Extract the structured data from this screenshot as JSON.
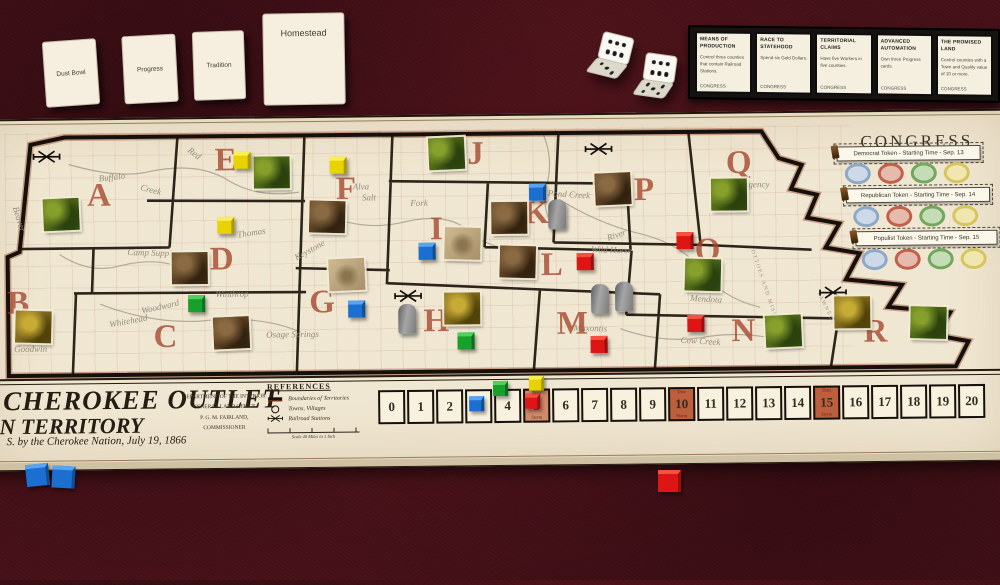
{
  "hand_cards": [
    {
      "label": "Dust Bowl",
      "x": 44,
      "y": 40,
      "w": 52,
      "h": 64,
      "rot": -4,
      "text_pos": "center"
    },
    {
      "label": "Progress",
      "x": 123,
      "y": 35,
      "w": 52,
      "h": 66,
      "rot": -3,
      "text_pos": "center"
    },
    {
      "label": "Tradition",
      "x": 193,
      "y": 31,
      "w": 50,
      "h": 67,
      "rot": -2,
      "text_pos": "center"
    },
    {
      "label": "Homestead",
      "x": 263,
      "y": 13,
      "w": 82,
      "h": 92,
      "rot": -1,
      "text_pos": "top"
    }
  ],
  "dice": [
    {
      "x": 598,
      "y": 34,
      "rot": 14,
      "top": 6,
      "front": 3
    },
    {
      "x": 643,
      "y": 54,
      "rot": 8,
      "top": 6,
      "front": 5
    }
  ],
  "goal_cards": {
    "x": 688,
    "y": 27,
    "w": 312,
    "h": 74,
    "cards": [
      {
        "title": "MEANS OF PRODUCTION",
        "body": "Control three counties that contain Railroad Stations.",
        "footer": "CONGRESS"
      },
      {
        "title": "RACE TO STATEHOOD",
        "body": "Spend six Gold Dollars.",
        "footer": "CONGRESS"
      },
      {
        "title": "TERRITORIAL CLAIMS",
        "body": "Have five Workers in five counties.",
        "footer": "CONGRESS"
      },
      {
        "title": "ADVANCED AUTOMATION",
        "body": "Own three Progress cards.",
        "footer": "CONGRESS"
      },
      {
        "title": "THE PROMISED LAND",
        "body": "Control counties with a Town and Quality value of 10 or more.",
        "footer": "CONGRESS"
      }
    ]
  },
  "board": {
    "congress": {
      "title": "CONGRESS",
      "title_x": 862,
      "title_y": 136,
      "oval_colors": [
        {
          "border": "#8fa8c8",
          "fill": "#cdd9e6"
        },
        {
          "border": "#c2604a",
          "fill": "#e4bbad"
        },
        {
          "border": "#72a85e",
          "fill": "#c4ddb6"
        },
        {
          "border": "#d8c45e",
          "fill": "#f0e7b0"
        }
      ],
      "rows": [
        {
          "label": "Democrat Token - Starting Time - Sep. 13",
          "bar_x": 838,
          "bar_y": 150,
          "bar_w": 142,
          "ovals_x": 846,
          "ovals_y": 167
        },
        {
          "label": "Republican Token - Starting Time - Sep. 14",
          "bar_x": 847,
          "bar_y": 192,
          "bar_w": 142,
          "ovals_x": 854,
          "ovals_y": 210
        },
        {
          "label": "Populist Token - Starting Time - Sep. 15",
          "bar_x": 856,
          "bar_y": 235,
          "bar_w": 140,
          "ovals_x": 862,
          "ovals_y": 253
        }
      ]
    },
    "counties": [
      {
        "letter": "A",
        "x": 100,
        "y": 192
      },
      {
        "letter": "B",
        "x": 18,
        "y": 299
      },
      {
        "letter": "C",
        "x": 165,
        "y": 334
      },
      {
        "letter": "D",
        "x": 222,
        "y": 257
      },
      {
        "letter": "E",
        "x": 227,
        "y": 158
      },
      {
        "letter": "F",
        "x": 347,
        "y": 188
      },
      {
        "letter": "G",
        "x": 322,
        "y": 301
      },
      {
        "letter": "H",
        "x": 436,
        "y": 321
      },
      {
        "letter": "I",
        "x": 437,
        "y": 229
      },
      {
        "letter": "J",
        "x": 477,
        "y": 154
      },
      {
        "letter": "K",
        "x": 537,
        "y": 214
      },
      {
        "letter": "L",
        "x": 552,
        "y": 266
      },
      {
        "letter": "M",
        "x": 572,
        "y": 325
      },
      {
        "letter": "N",
        "x": 743,
        "y": 334
      },
      {
        "letter": "O",
        "x": 708,
        "y": 253
      },
      {
        "letter": "P",
        "x": 645,
        "y": 192
      },
      {
        "letter": "Q",
        "x": 740,
        "y": 166
      },
      {
        "letter": "R",
        "x": 875,
        "y": 336
      }
    ],
    "map_labels": [
      {
        "t": "Buffalo",
        "x": 113,
        "y": 173,
        "r": -6
      },
      {
        "t": "Creek",
        "x": 152,
        "y": 186,
        "r": 14
      },
      {
        "t": "Beaver",
        "x": 20,
        "y": 214,
        "r": 74
      },
      {
        "t": "Camp Supply",
        "x": 152,
        "y": 249,
        "r": 2
      },
      {
        "t": "Red",
        "x": 196,
        "y": 150,
        "r": 38
      },
      {
        "t": "Thomas",
        "x": 252,
        "y": 230,
        "r": -8
      },
      {
        "t": "Alva",
        "x": 362,
        "y": 185,
        "r": 0
      },
      {
        "t": "Salt",
        "x": 370,
        "y": 196,
        "r": 0
      },
      {
        "t": "Fork",
        "x": 420,
        "y": 202,
        "r": 0
      },
      {
        "t": "Keystone",
        "x": 310,
        "y": 248,
        "r": -28
      },
      {
        "t": "Pond Creek",
        "x": 570,
        "y": 195,
        "r": 4
      },
      {
        "t": "River",
        "x": 617,
        "y": 236,
        "r": -18
      },
      {
        "t": "Wild Horse",
        "x": 612,
        "y": 251,
        "r": 2
      },
      {
        "t": "Mendota",
        "x": 706,
        "y": 301,
        "r": 4
      },
      {
        "t": "Cow Creek",
        "x": 700,
        "y": 343,
        "r": 4
      },
      {
        "t": "Muxontis",
        "x": 590,
        "y": 329,
        "r": 2
      },
      {
        "t": "Whitehead",
        "x": 128,
        "y": 317,
        "r": -10
      },
      {
        "t": "Woodward",
        "x": 160,
        "y": 303,
        "r": -12
      },
      {
        "t": "Goodwin",
        "x": 30,
        "y": 344,
        "r": 0
      },
      {
        "t": "Osage Springs",
        "x": 292,
        "y": 332,
        "r": 0
      },
      {
        "t": "Winthrop",
        "x": 232,
        "y": 291,
        "r": 0
      },
      {
        "t": "Kaw Agency",
        "x": 748,
        "y": 187,
        "r": 0
      },
      {
        "t": "OTTOES AND MISSOURIES",
        "x": 768,
        "y": 300,
        "r": 72
      },
      {
        "t": "PAWNEES",
        "x": 826,
        "y": 312,
        "r": 64
      }
    ],
    "pieces": {
      "tiles": [
        {
          "variant": "green",
          "x": 44,
          "y": 194,
          "county": "A"
        },
        {
          "variant": "green",
          "x": 255,
          "y": 154,
          "county": "E"
        },
        {
          "variant": "gold",
          "x": 15,
          "y": 306,
          "county": "B"
        },
        {
          "variant": "brown",
          "x": 213,
          "y": 314,
          "county": "C"
        },
        {
          "variant": "brown",
          "x": 172,
          "y": 249,
          "county": "D"
        },
        {
          "variant": "brown",
          "x": 310,
          "y": 199,
          "county": "F"
        },
        {
          "variant": "light",
          "x": 329,
          "y": 257,
          "county": "G"
        },
        {
          "variant": "gold",
          "x": 444,
          "y": 292,
          "county": "H"
        },
        {
          "variant": "light",
          "x": 445,
          "y": 227,
          "county": "I"
        },
        {
          "variant": "green",
          "x": 430,
          "y": 137,
          "county": "J"
        },
        {
          "variant": "brown",
          "x": 492,
          "y": 202,
          "county": "K"
        },
        {
          "variant": "brown",
          "x": 500,
          "y": 246,
          "county": "L"
        },
        {
          "variant": "brown",
          "x": 596,
          "y": 174,
          "county": "P"
        },
        {
          "variant": "green",
          "x": 712,
          "y": 181,
          "county": "Q"
        },
        {
          "variant": "green",
          "x": 685,
          "y": 261,
          "county": "O"
        },
        {
          "variant": "green",
          "x": 765,
          "y": 318,
          "county": "N"
        },
        {
          "variant": "gold",
          "x": 834,
          "y": 300,
          "county": "R"
        },
        {
          "variant": "green",
          "x": 910,
          "y": 311,
          "county": "R"
        }
      ],
      "cubes": [
        {
          "color": "yellow",
          "x": 235,
          "y": 149,
          "county": "E"
        },
        {
          "color": "yellow",
          "x": 218,
          "y": 214,
          "county": "D"
        },
        {
          "color": "yellow",
          "x": 331,
          "y": 155,
          "county": "F"
        },
        {
          "color": "green",
          "x": 188,
          "y": 292,
          "county": "C"
        },
        {
          "color": "green",
          "x": 457,
          "y": 332,
          "county": "H"
        },
        {
          "color": "blue",
          "x": 419,
          "y": 242,
          "county": "I"
        },
        {
          "color": "blue",
          "x": 530,
          "y": 184,
          "county": "K"
        },
        {
          "color": "blue",
          "x": 348,
          "y": 299,
          "county": "G"
        },
        {
          "color": "red",
          "x": 577,
          "y": 254,
          "county": "L"
        },
        {
          "color": "red",
          "x": 677,
          "y": 234,
          "county": "O"
        },
        {
          "color": "red",
          "x": 590,
          "y": 337,
          "county": "M"
        },
        {
          "color": "red",
          "x": 687,
          "y": 317,
          "county": "N"
        }
      ],
      "markers": [
        {
          "x": 549,
          "y": 200,
          "county": "K"
        },
        {
          "x": 398,
          "y": 303,
          "county": "H"
        },
        {
          "x": 591,
          "y": 285,
          "county": "M"
        },
        {
          "x": 615,
          "y": 283,
          "county": "M"
        }
      ],
      "railroads": [
        {
          "x": 33,
          "y": 145,
          "county": "A"
        },
        {
          "x": 585,
          "y": 143,
          "county": "P"
        },
        {
          "x": 393,
          "y": 288,
          "county": "H"
        },
        {
          "x": 818,
          "y": 289,
          "county": "R"
        }
      ]
    },
    "title_block": {
      "line1": "CHEROKEE OUTLET",
      "line2": "N TERRITORY",
      "line3": "S. by the Cherokee Nation, July 19, 1866"
    },
    "dept_block": [
      "DEPARTMENT OF THE INTERIOR",
      "GENERAL LAND OFFICE",
      "P. G. M. FAIRLAND, COMMISSIONER"
    ],
    "references": {
      "title": "REFERENCES",
      "items": [
        {
          "swatch": "boundary",
          "label": "Boundaries of Territories"
        },
        {
          "swatch": "town",
          "label": "Towns, Villages"
        },
        {
          "swatch": "railroad",
          "label": "Railroad Stations"
        }
      ],
      "scale": "Scale 40 Miles to 1 Inch"
    },
    "track": {
      "start": 0,
      "end": 20,
      "special_cells": {
        "5": "light",
        "10": "dark",
        "15": "dark"
      },
      "special_top": "Dust",
      "special_bottom": "Storm",
      "cubes": [
        {
          "color": "blue",
          "x": 468,
          "y": 396,
          "cell": 3
        },
        {
          "color": "green",
          "x": 492,
          "y": 381,
          "cell": 4
        },
        {
          "color": "red",
          "x": 524,
          "y": 394,
          "cell": 5
        },
        {
          "color": "yellow",
          "x": 528,
          "y": 376,
          "cell": 5
        }
      ]
    }
  },
  "loose_cubes": [
    {
      "color": "blue",
      "x": 26,
      "y": 464,
      "rot": -6
    },
    {
      "color": "blue",
      "x": 52,
      "y": 466,
      "rot": 3
    },
    {
      "color": "red",
      "x": 658,
      "y": 470,
      "rot": 0
    }
  ],
  "cube_colors": {
    "blue": {
      "face": "#1b6fd0",
      "top": "#5aa4ef",
      "side": "#114f92"
    },
    "red": {
      "face": "#de1515",
      "top": "#f85040",
      "side": "#991010"
    },
    "green": {
      "face": "#17a12b",
      "top": "#52cf5e",
      "side": "#0d7020"
    },
    "yellow": {
      "face": "#e6d300",
      "top": "#f8ee55",
      "side": "#a89a00"
    }
  }
}
